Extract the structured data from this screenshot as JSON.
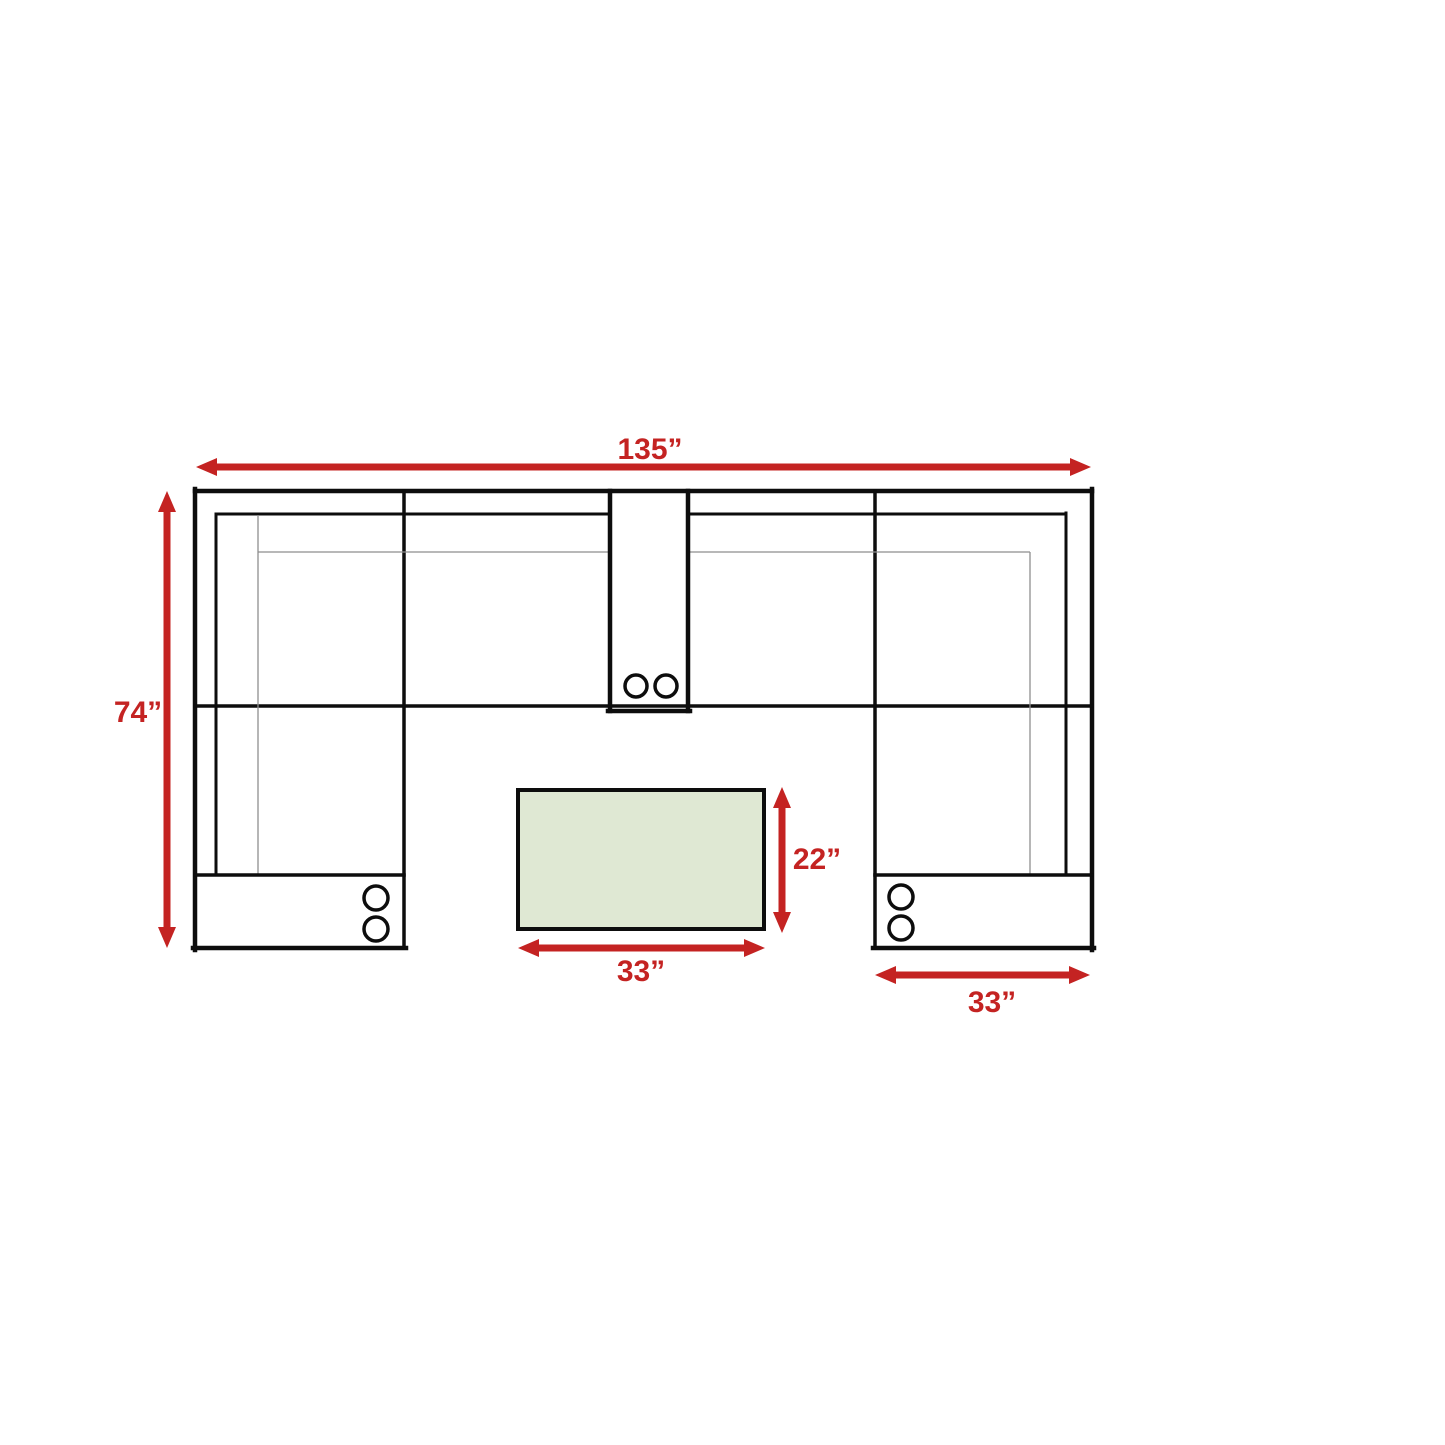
{
  "diagram": {
    "unit": "inches",
    "labels": {
      "overall_width": "135”",
      "overall_depth": "74”",
      "table_depth": "22”",
      "table_width": "33”",
      "chaise_width": "33”"
    },
    "values": {
      "overall_width_in": 135,
      "overall_depth_in": 74,
      "table_depth_in": 22,
      "table_width_in": 33,
      "chaise_width_in": 33
    },
    "colors": {
      "arrow_red": "#c42322",
      "text_red": "#c42322",
      "outline_black": "#0d0d0d",
      "seam_gray": "#8e8e8e",
      "table_fill": "#dfe8d3",
      "background": "#ffffff"
    }
  }
}
